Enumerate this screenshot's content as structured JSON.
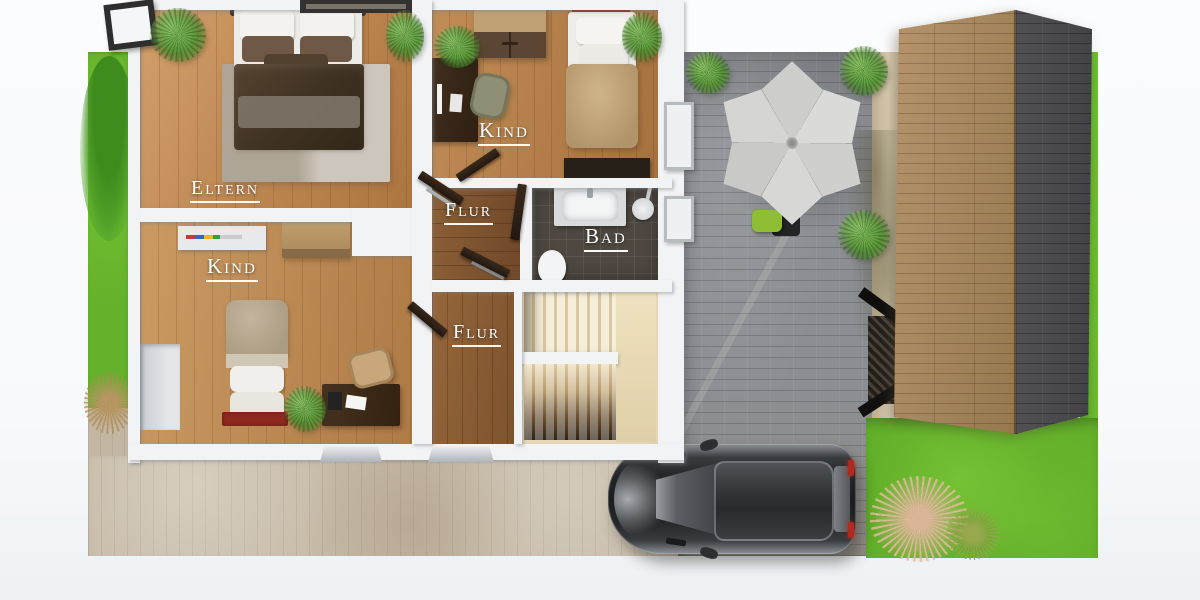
{
  "rooms": {
    "eltern": {
      "label": "Eltern"
    },
    "kind_top": {
      "label": "Kind"
    },
    "kind_bottom": {
      "label": "Kind"
    },
    "flur_top": {
      "label": "Flur"
    },
    "flur_bottom": {
      "label": "Flur"
    },
    "bad": {
      "label": "Bad"
    }
  },
  "palette": {
    "background": "#f8f9fa",
    "wall_white": "#f2f3f5",
    "wood_light": "#c08a55",
    "wood_dark": "#7c5530",
    "bath_tile": "#4e4841",
    "stair_cream": "#e7d7b4",
    "grass_green": "#66b42c",
    "patio_stone": "#8b8e92",
    "driveway_beige": "#c7bba7",
    "roof_brown": "#a2835c",
    "roof_gray": "#4b4b4f",
    "umbrella_gray": "#d4d4d2",
    "car_black": "#1d1e20",
    "accent_red": "#8e241c"
  }
}
